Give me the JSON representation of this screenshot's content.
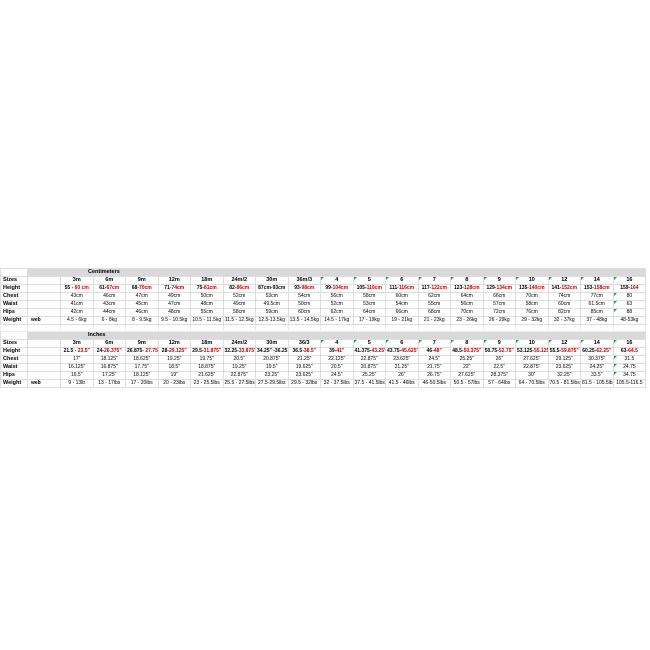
{
  "colors": {
    "accent_red": "#c00000",
    "header_gray": "#d9d9d9",
    "gridline": "#dedede",
    "flag_green": "#2c9a46",
    "background": "#ffffff"
  },
  "table": {
    "row_labels": [
      "Sizes",
      "Height",
      "Chest",
      "Waist",
      "Hips",
      "Weight"
    ],
    "web_label": "web",
    "sections": [
      {
        "id": "cm",
        "title": "Centimeters",
        "sizes": [
          "3m",
          "6m",
          "9m",
          "12m",
          "18m",
          "24m/2",
          "30m",
          "36m/3",
          "4",
          "5",
          "6",
          "7",
          "8",
          "9",
          "10",
          "12",
          "14",
          "16"
        ],
        "header_flags": [
          false,
          false,
          false,
          false,
          false,
          false,
          false,
          false,
          true,
          true,
          true,
          true,
          true,
          true,
          true,
          true,
          true,
          true
        ],
        "height": [
          {
            "black": "55 - ",
            "red": "60 cm"
          },
          {
            "black": "61-",
            "red": "67cm"
          },
          {
            "black": "68-",
            "red": "70cm"
          },
          {
            "black": "71-",
            "red": "74cm"
          },
          {
            "black": "75-",
            "red": "81cm"
          },
          {
            "black": "82-",
            "red": "86cm"
          },
          {
            "black": "87cm-93cm",
            "red": ""
          },
          {
            "black": "93-",
            "red": "98cm"
          },
          {
            "black": "99-",
            "red": "104cm"
          },
          {
            "black": "105-",
            "red": "110cm"
          },
          {
            "black": "111-",
            "red": "116cm"
          },
          {
            "black": "117-",
            "red": "122cm"
          },
          {
            "black": "123-",
            "red": "128cm"
          },
          {
            "black": "129-",
            "red": "134cm"
          },
          {
            "black": "135-",
            "red": "140cm"
          },
          {
            "black": "141-",
            "red": "152cm"
          },
          {
            "black": "153-",
            "red": "158cm"
          },
          {
            "black": "159-",
            "red": "164"
          }
        ],
        "chest": [
          "43cm",
          "46cm",
          "47cm",
          "49cm",
          "50cm",
          "52cm",
          "53cm",
          "54cm",
          "56cm",
          "58cm",
          "60cm",
          "62cm",
          "64cm",
          "66cm",
          "70cm",
          "74cm",
          "77cm",
          "80"
        ],
        "waist": [
          "41cm",
          "43cm",
          "45cm",
          "47cm",
          "48cm",
          "49cm",
          "49.5cm",
          "50cm",
          "52cm",
          "53cm",
          "54cm",
          "55cm",
          "56cm",
          "57cm",
          "58cm",
          "60cm",
          "61.5cm",
          "63"
        ],
        "hips": [
          "42cm",
          "44cm",
          "46cm",
          "48cm",
          "55cm",
          "58cm",
          "59cm",
          "60cm",
          "62cm",
          "64cm",
          "66cm",
          "68cm",
          "70cm",
          "72cm",
          "76cm",
          "82cm",
          "85cm",
          "88"
        ],
        "weight": [
          "4.5 - 6kg",
          "6 - 8kg",
          "8 - 9.5kg",
          "9.5 - 10.5kg",
          "10.5 - 11.5kg",
          "11.5 - 12.5kg",
          "12.5-13.5kg",
          "13.5 - 14.5kg",
          "14.5 - 17kg",
          "17 - 19kg",
          "19 - 21kg",
          "21 - 23kg",
          "23 - 26kg",
          "26 - 29kg",
          "29 - 32kg",
          "32 - 37kg",
          "37 - 48kg",
          "48-53kg"
        ],
        "value_flags": {
          "chest": [
            17
          ],
          "waist": [
            17
          ],
          "hips": [
            17
          ]
        }
      },
      {
        "id": "in",
        "title": "Inches",
        "sizes": [
          "3m",
          "6m",
          "9m",
          "12m",
          "18m",
          "24m/2",
          "30m",
          "36/3",
          "4",
          "5",
          "6",
          "7",
          "8",
          "9",
          "10",
          "12",
          "14",
          "16"
        ],
        "header_flags": [
          false,
          false,
          false,
          false,
          false,
          false,
          false,
          false,
          true,
          true,
          true,
          true,
          true,
          true,
          true,
          true,
          true,
          true
        ],
        "height": [
          {
            "black": "21.5 - ",
            "red": "23.5\""
          },
          {
            "black": "24-",
            "red": "26.375\""
          },
          {
            "black": "26.875- ",
            "red": "27.75\""
          },
          {
            "black": "28-",
            "red": "29.125\""
          },
          {
            "black": "29.5-",
            "red": "31.875\""
          },
          {
            "black": "32.25-",
            "red": "33.875\""
          },
          {
            "black": "34.25\" -36.25",
            "red": ""
          },
          {
            "black": "36.5-",
            "red": "38.5\""
          },
          {
            "black": "39-",
            "red": "41\""
          },
          {
            "black": "41.375-",
            "red": "43.25\""
          },
          {
            "black": "43.75-",
            "red": "45.625\""
          },
          {
            "black": "46-",
            "red": "48\""
          },
          {
            "black": "48.5-",
            "red": "50.375\""
          },
          {
            "black": "50.75-",
            "red": "52.75\""
          },
          {
            "black": "53.125-",
            "red": "55.125\""
          },
          {
            "black": "55.5-",
            "red": "59.875\""
          },
          {
            "black": "60.25-",
            "red": "62.25\""
          },
          {
            "black": "63-",
            "red": "64.5"
          }
        ],
        "chest": [
          "17\"",
          "18.125\"",
          "18.625\"",
          "19.25\"",
          "19.75\"",
          "20.5\"",
          "20.875\"",
          "21.25\"",
          "22.125\"",
          "22.875\"",
          "23.625\"",
          "24.5\"",
          "25.25\"",
          "26\"",
          "27.625\"",
          "29.125\"",
          "30.375\"",
          "31.5"
        ],
        "waist": [
          "16.125\"",
          "16.875\"",
          "17.75\"",
          "18.5\"",
          "18.875\"",
          "19.25\"",
          "19.5\"",
          "19.625\"",
          "20.5\"",
          "20.875\"",
          "21.25\"",
          "21.75\"",
          "22\"",
          "22.5\"",
          "22.875\"",
          "23.625\"",
          "24.25\"",
          "24.75"
        ],
        "hips": [
          "16.5\"",
          "17.25\"",
          "18.125\"",
          "19\"",
          "21.625\"",
          "22.875\"",
          "23.25\"",
          "23.625\"",
          "24.5\"",
          "25.25\"",
          "26\"",
          "26.75\"",
          "27.625\"",
          "28.375\"",
          "30\"",
          "32.25\"",
          "33.5\"",
          "34.75"
        ],
        "weight": [
          "9 - 13lb",
          "13 - 17lbs",
          "17 - 20lbs",
          "20 - 23lbs",
          "23 - 25.5lbs",
          "25.5 - 27.5lbs",
          "27.5-29.5lbs",
          "29.5 - 32lbs",
          "32 - 37.5lbs",
          "37.5 - 41.5lbs",
          "41.5 - 46lbs",
          "46-50.5lbs",
          "50.5 - 57lbs",
          "57 - 64lbs",
          "64 - 70.5lbs",
          "70.5 - 81.5lbs",
          "81.5 - 105.5lbs",
          "105.5-116.5"
        ],
        "value_flags": {
          "chest": [
            17
          ],
          "waist": [
            17
          ],
          "hips": [
            17
          ]
        }
      }
    ]
  }
}
